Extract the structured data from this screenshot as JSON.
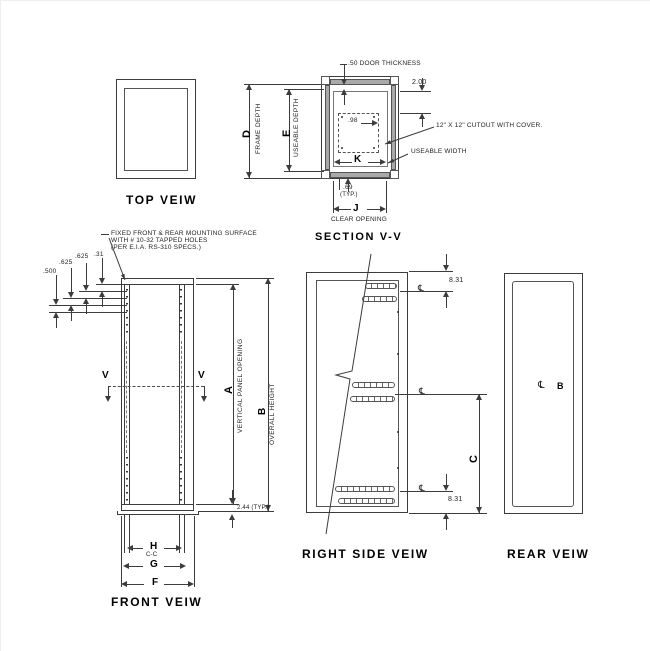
{
  "drawing": {
    "top_view": {
      "title": "TOP VEIW"
    },
    "depth_dims": {
      "d": "D",
      "d_label": "FRAME DEPTH",
      "e": "E",
      "e_label": "USEABLE DEPTH"
    },
    "section_view": {
      "title": "SECTION V-V",
      "door_thickness": ".50 DOOR THICKNESS",
      "dim_2_00": "2.00",
      "dim_98": ".98",
      "cutout_note": "12\" X 12\" CUTOUT WITH COVER.",
      "useable_width": "USEABLE WIDTH",
      "k": "K",
      "dim_69": ".69",
      "typ": "(TYP.)",
      "j": "J",
      "clear_opening": "CLEAR OPENING"
    },
    "front_view": {
      "title": "FRONT VEIW",
      "mounting_note": [
        "FIXED FRONT & REAR MOUNTING SURFACE",
        "WITH # 10-32 TAPPED HOLES",
        "(PER E.I.A. RS-310 SPECS.)"
      ],
      "dim_500": ".500",
      "dim_625_a": ".625",
      "dim_625_b": ".625",
      "dim_31": ".31",
      "v_left": "V",
      "v_right": "V",
      "a": "A",
      "a_label": "VERTICAL PANEL OPENING",
      "b": "B",
      "b_label": "OVERALL HEIGHT",
      "dim_244": "2.44 (TYP.)",
      "h": "H",
      "h_sub": "C-C",
      "g": "G",
      "f": "F"
    },
    "right_view": {
      "title": "RIGHT SIDE VEIW",
      "dim_831_top": "8.31",
      "dim_831_bottom": "8.31",
      "c": "C",
      "cl_top": "℄",
      "cl_mid": "℄",
      "cl_bottom": "℄"
    },
    "rear_view": {
      "title": "REAR VEIW",
      "cl": "℄",
      "b": "B"
    }
  }
}
